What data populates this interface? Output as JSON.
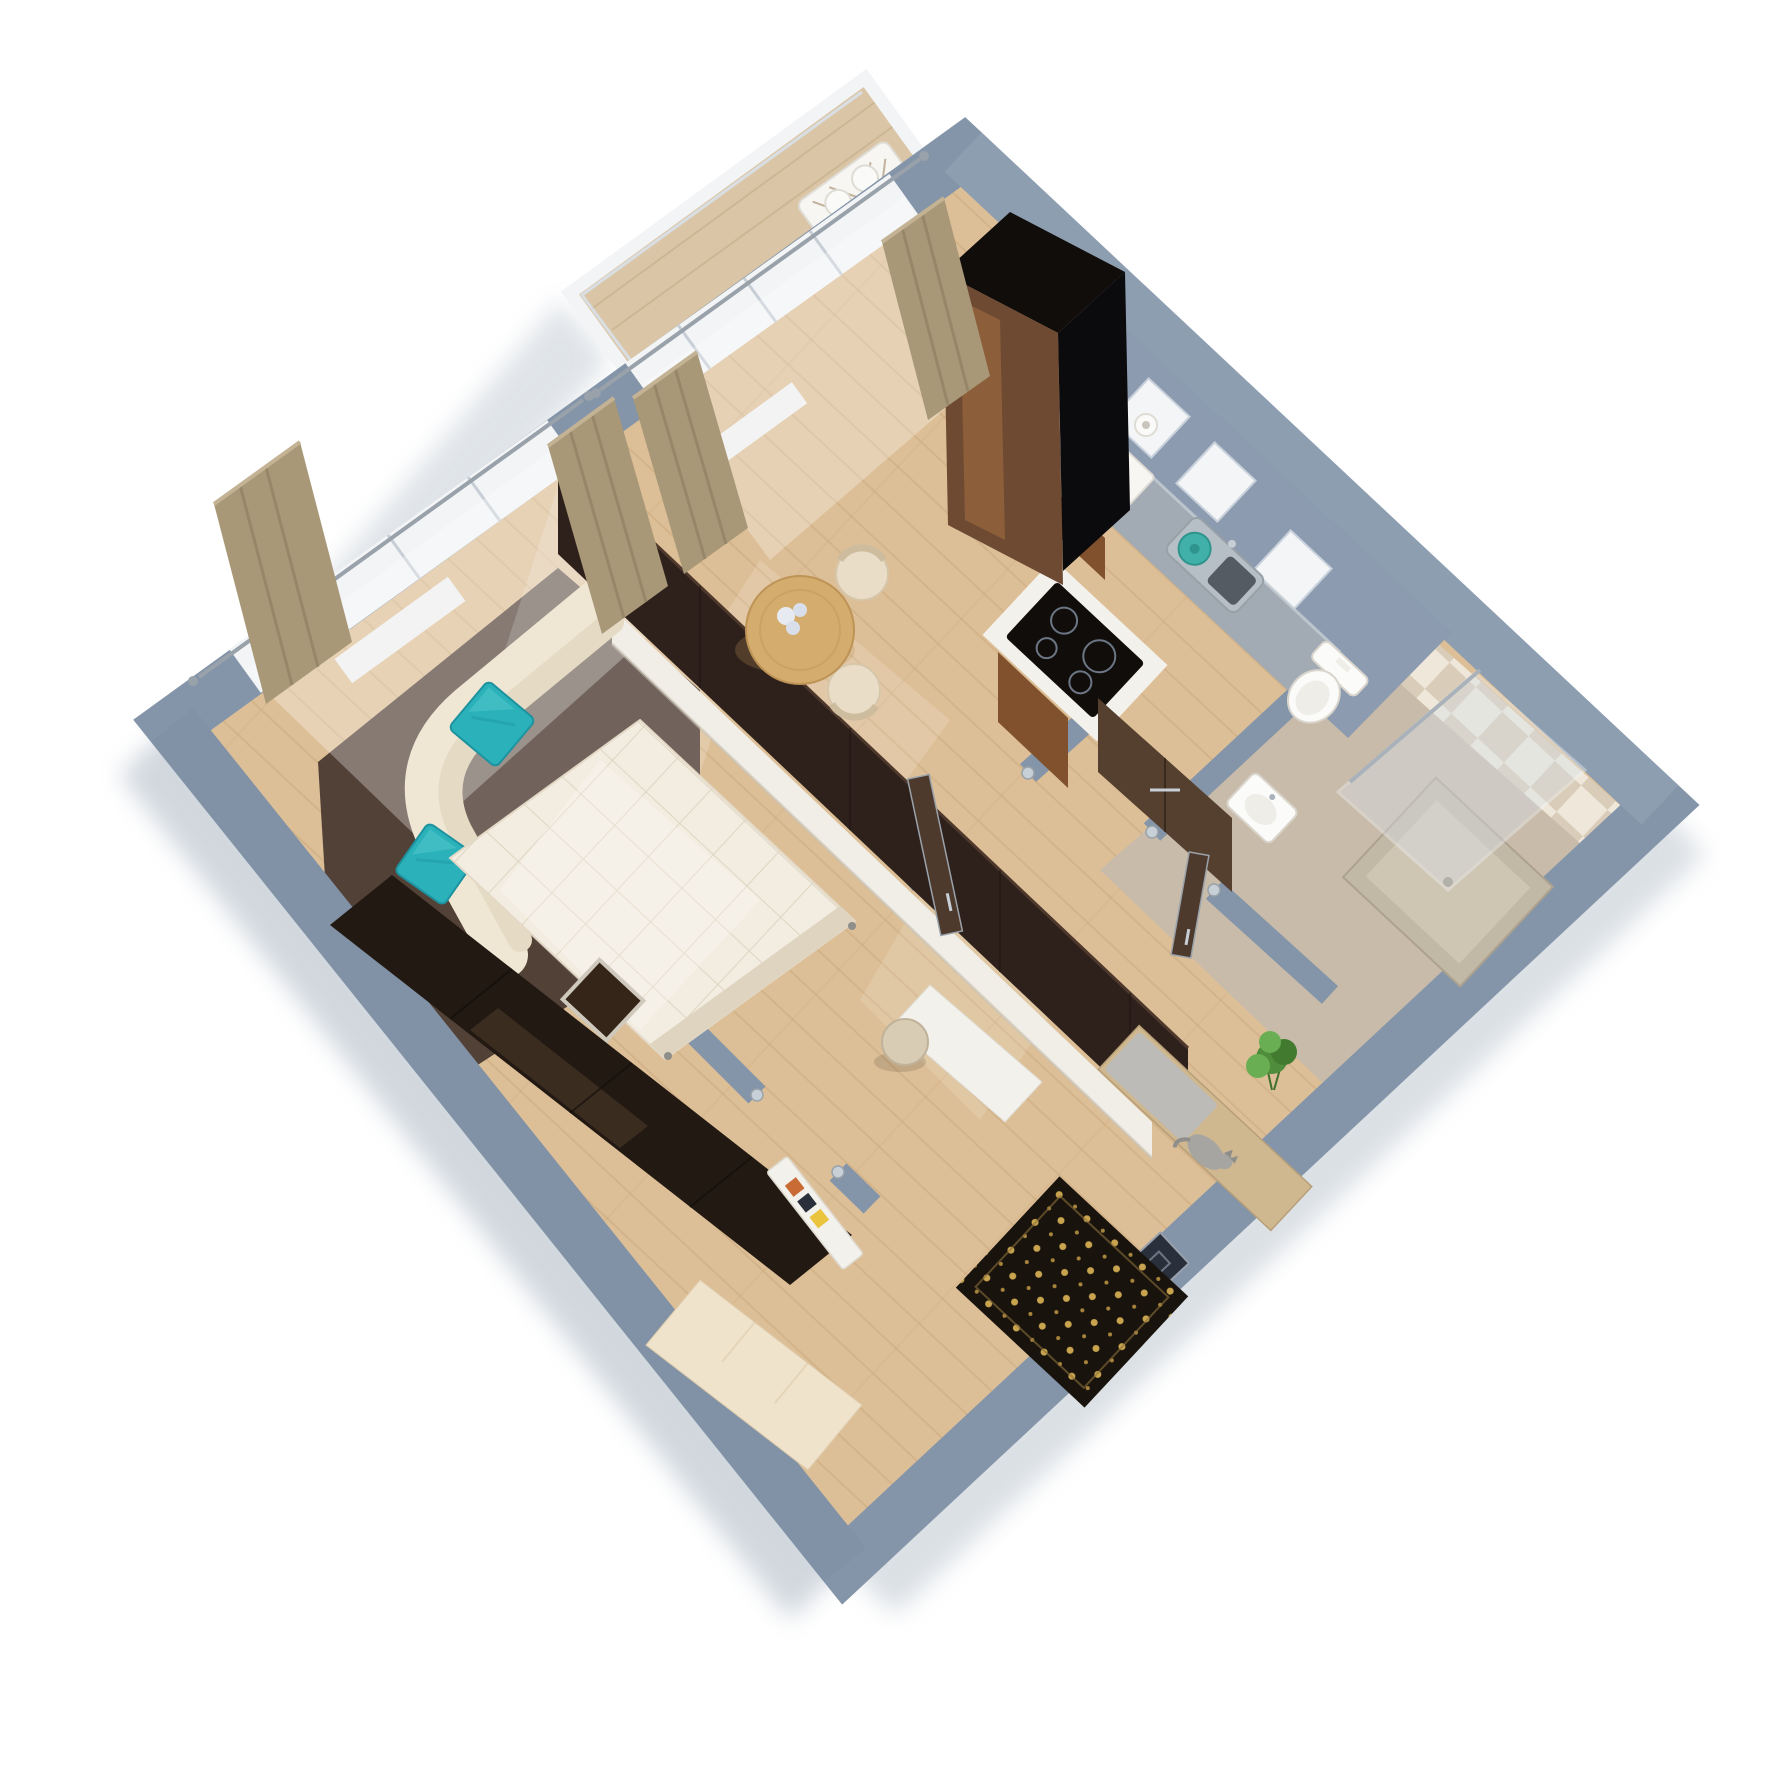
{
  "scene": {
    "kind": "isometric 3d floor plan render",
    "background": "#FFFFFF",
    "apartment_type": "studio apartment with balcony"
  },
  "rooms": [
    {
      "name": "living-room",
      "items": [
        "corner-sofa",
        "teal-pillow",
        "teal-pillow",
        "double-bed",
        "nightstand",
        "dark-area-rug",
        "wardrobe",
        "window",
        "curtains",
        "curtain-rod"
      ]
    },
    {
      "name": "kitchen-dining",
      "items": [
        "tall-black-cabinet",
        "kitchen-counter",
        "sink",
        "teal-pot",
        "fruit-basket",
        "cooktop",
        "round-dining-table",
        "dining-chair",
        "dining-chair",
        "flower-vase",
        "balcony-door",
        "curtains"
      ]
    },
    {
      "name": "balcony",
      "items": [
        "wood-deck",
        "white-railing",
        "lattice-bench",
        "pillows"
      ]
    },
    {
      "name": "bathroom",
      "items": [
        "toilet",
        "washbasin",
        "shower",
        "glass-panel",
        "checker-tile-wall",
        "brown-cabinet"
      ]
    },
    {
      "name": "hallway",
      "items": [
        "tv-partition",
        "white-console",
        "desk",
        "stool",
        "entry-rug",
        "bench",
        "plant",
        "cat",
        "shoe-cabinet",
        "entrance-door",
        "interior-door",
        "white-door"
      ]
    }
  ],
  "colors": {
    "bg": "#FFFFFF",
    "shadowOut": "#9AA7B5",
    "wall": "#8495A9",
    "wallLight": "#9AA9BC",
    "wallDark": "#7B8CA1",
    "floor": "#DDBF97",
    "plank": "#C9A87C",
    "window": "#F2F4F5",
    "mullion": "#C7CED6",
    "rod": "#99A1AA",
    "deck": "#DAC6A6",
    "deckLine": "#C4AC87",
    "railing": "#F3F4F6",
    "railInner": "#D9DEE3",
    "curtain": "#A89878",
    "curtainDark": "#8F8064",
    "curtainHi": "#C3B293",
    "cabinetBlack": "#100D0B",
    "bronze": "#6E4A33",
    "bronzeHi": "#A9713F",
    "cabinetSide": "#0B0A0D",
    "counter": "#A2ABB4",
    "counterEdge": "#C6CDD4",
    "woodCab": "#80512C",
    "steel": "#B6BEC6",
    "steelEdge": "#98A0A8",
    "steelDark": "#555B63",
    "potTeal": "#41B0A8",
    "potTealDark": "#2E948D",
    "basket": "#F7F6F3",
    "basketEdge": "#DFDCD5",
    "fruitOrange": "#E8A32A",
    "fruitYellow": "#E9C43C",
    "fruitRed": "#C96B35",
    "roll": "#FAFAF8",
    "rollHole": "#C9C5BC",
    "shaft": "#8C9BAF",
    "niche": "#F4F5F6",
    "nicheEdge": "#C9D2DC",
    "bathFloor": "#C8BBA9",
    "tileA": "#EFE8DA",
    "tileB": "#D9CCB8",
    "fixture": "#FBFBF9",
    "fixtureEdge": "#D9D5CD",
    "fixtureInner": "#EFEDE8",
    "tray": "#C2B8A6",
    "trayEdge": "#ADA28E",
    "trayInner": "#CFC5B3",
    "drain": "#9A8F7B",
    "glassBlue": "#D8E2EB",
    "glassEdge": "#F0F4F8",
    "chrome": "#A9B2BA",
    "wenge": "#2E211B",
    "wengeHi": "#4E382C",
    "wengeSeam": "#1D1511",
    "console": "#F1EEE7",
    "consoleShadow": "#C9C2B4",
    "desk": "#F3F1EB",
    "deskEdge": "#DEDAD0",
    "stool": "#D8CCB5",
    "stoolEdge": "#C1B29A",
    "tableWood": "#D4AC6E",
    "tableEdge": "#BD9356",
    "tableRing": "#C49B5E",
    "flowerA": "#E8EAF2",
    "flowerB": "#D8DEEA",
    "chair": "#E9DDC7",
    "chairEdge": "#D6C6AA",
    "chairBack": "#CDBC9E",
    "sofa": "#EFE6D4",
    "sofaSeat": "#E5DAC4",
    "rugDark": "#4A3A31",
    "teal": "#2BB1BA",
    "tealDark": "#1E93A0",
    "tealHi": "#49C2C8",
    "tealFold": "#25A5AF",
    "bed": "#F3EDE1",
    "bedEdge": "#E3D9C6",
    "quilt": "#DCD2BE",
    "bedFoot": "#DED4C0",
    "feet": "#8E8E8A",
    "night": "#352418",
    "nightRim": "#CFC8BC",
    "wardrobe": "#221912",
    "wardrobeHi": "#6B4F3B",
    "wardrobeSeam": "#100C08",
    "creamCab": "#EFE3CC",
    "creamCabEdge": "#DECBAB",
    "doorBrown": "#4E3A2C",
    "doorBrown2": "#553F2F",
    "silver": "#C7CFD7",
    "silverDark": "#9AA2AA",
    "entryDoor": "#2A303B",
    "entryDoorEdge": "#97A0AC",
    "entryPanel": "#6C7684",
    "rugBlack": "#19130D",
    "rugGold": "#C9A44E",
    "rugGold2": "#A8853C",
    "rugBorder": "#8A6F3A",
    "benchWood": "#CFB890",
    "benchEdge": "#B89F78",
    "cushion": "#BCBBB7",
    "plant": "#4F8C3B",
    "plantDark": "#427A30",
    "plantLight": "#69AE52",
    "stem": "#3E6F2C",
    "pot": "#C8B292",
    "cat": "#A6A5A1",
    "catDark": "#8F8E8A",
    "white": "#FFFFFF"
  }
}
